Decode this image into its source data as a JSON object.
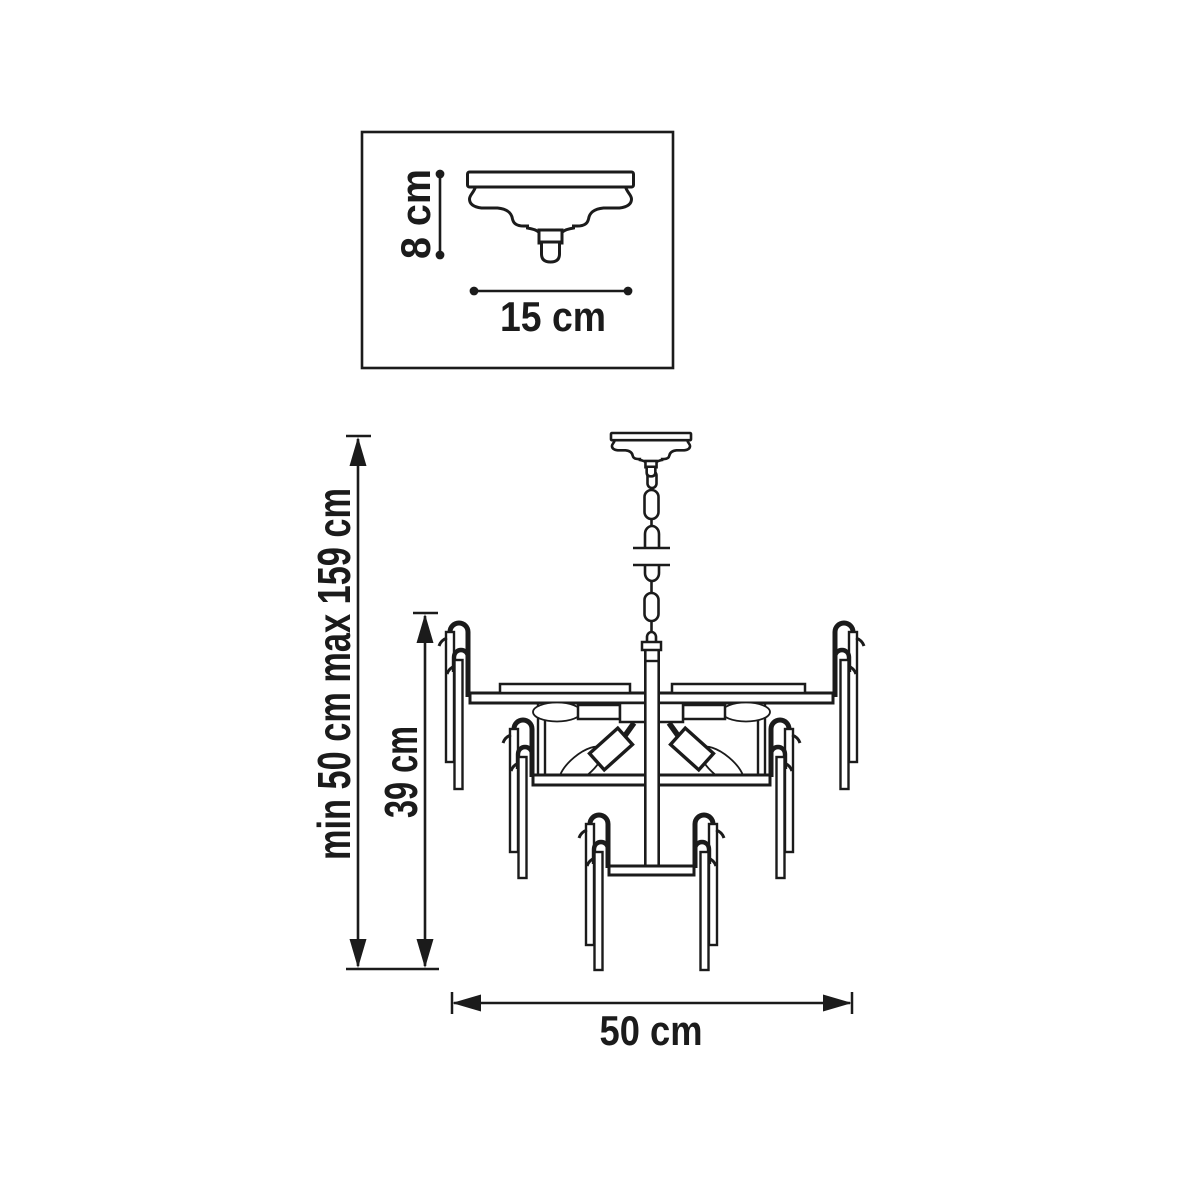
{
  "figure": {
    "kind": "chandelier-dimension-diagram",
    "background": "#ffffff",
    "line_color": "#1b1b1b"
  },
  "detail_box": {
    "height_label": "8 cm",
    "width_label": "15 cm"
  },
  "dimensions": {
    "overall_height_label": "min 50 cm max 159 cm",
    "fixture_height_label": "39 cm",
    "width_label": "50 cm"
  }
}
